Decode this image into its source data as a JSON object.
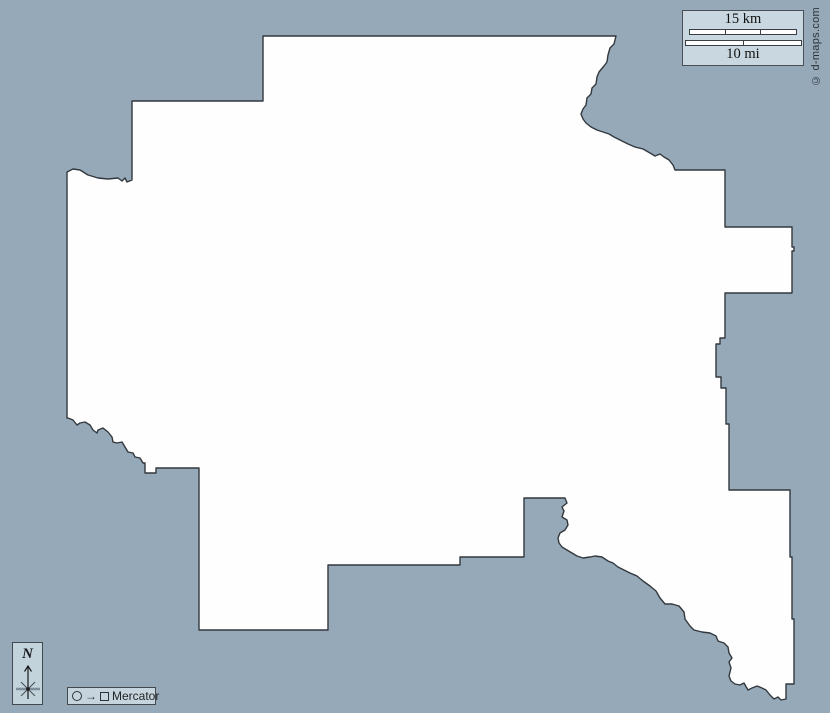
{
  "map": {
    "water_fill": "#95a9b9",
    "region_fill": "#fefefe",
    "outline_color": "#33383d",
    "outline_points": "263,36 616,36 614,44 610,48 608,55 607,62 604,66 599,72 597,77 596,84 592,88 591,94 587,98 586,105 583,109 581,114 583,119 586,123 591,127 597,130 603,132 609,134 614,137 622,141 628,144 635,147 643,149 650,153 655,156 660,154 664,157 669,160 673,165 675,170 725,170 725,227 792,227 792,247 794,247 794,251 792,251 792,293 725,293 725,338 720,338 720,344 716,344 716,377 721,377 721,388 726,388 726,424 729,424 729,490 790,490 790,557 792,557 792,619 794,619 794,684 786,684 786,699 781,700 778,697 774,699 770,695 766,690 762,688 757,686 752,688 748,690 744,683 740,685 735,684 731,681 729,676 731,668 729,662 732,658 729,653 728,647 724,643 718,641 716,636 710,633 702,632 694,630 690,626 685,619 684,612 679,606 672,604 665,604 660,598 656,591 650,586 643,581 637,576 630,573 624,570 618,567 613,563 608,561 605,559 602,557 595,556 590,557 583,558 577,556 572,553 567,550 562,547 559,543 558,538 560,533 565,530 568,525 567,520 562,517 564,511 562,507 567,503 565,498 524,498 524,557 460,557 460,565 328,565 328,630 199,630 199,468 156,468 156,473 145,473 145,463 143,463 140,458 135,457 133,453 128,452 125,447 122,442 117,443 113,442 112,437 108,432 103,428 98,430 97,433 93,430 90,425 85,422 80,423 77,425 73,420 68,418 67,418 67,172 73,169 80,170 88,175 98,178 108,179 118,178 122,181 125,178 127,182 132,180 132,101 263,101"
  },
  "scale_bar": {
    "km_label": "15 km",
    "mi_label": "10 mi"
  },
  "copyright": "© d-maps.com",
  "compass": {
    "north_label": "N"
  },
  "projection": {
    "circle_icon": "circle-outline",
    "arrow_glyph": "→",
    "square_icon": "square-outline",
    "label": "Mercator"
  }
}
